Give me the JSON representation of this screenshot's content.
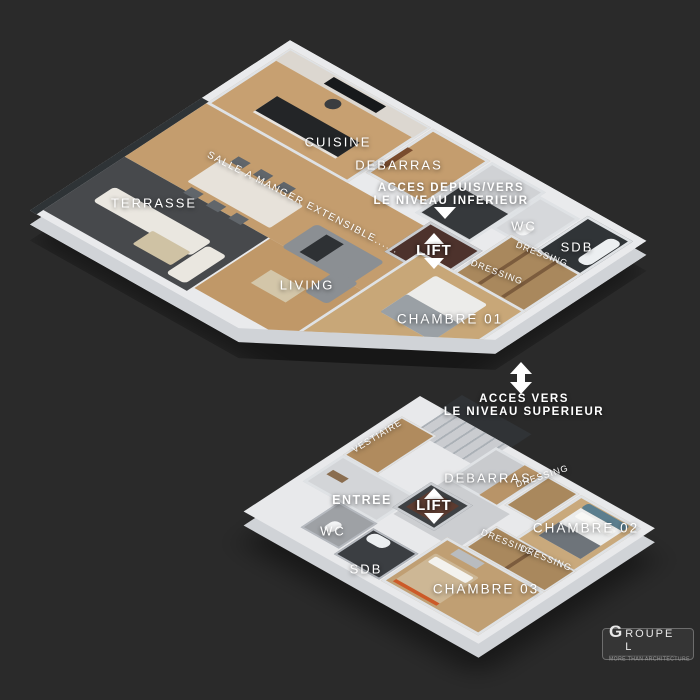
{
  "background": "#2a2a2a",
  "palette": {
    "slab": "#e9eaec",
    "wood_floor": "#c49d6e",
    "terrace_floor": "#47494c",
    "dark_room": "#33363a",
    "dressing_wood": "#a9885d",
    "lift_shaft": "#4d322c",
    "glass": "#8cb1ba",
    "bed_teal": "#5b7e8e",
    "label_text": "#ffffff"
  },
  "upper_floor": {
    "labels": {
      "terrasse": "TERRASSE",
      "cuisine": "CUISINE",
      "debarras": "DEBARRAS",
      "salle_a_manger": "SALLE A MANGER EXTENSIBLE......",
      "living": "LIVING",
      "wc": "WC",
      "sdb": "SDB",
      "dressing_a": "DRESSING",
      "dressing_b": "DRESSING",
      "chambre_01": "CHAMBRE 01",
      "lift": "LIFT"
    },
    "access_note": {
      "line1": "ACCES DEPUIS/VERS",
      "line2": "LE NIVEAU INFERIEUR"
    }
  },
  "stair_note": {
    "line1": "ACCES VERS",
    "line2": "LE NIVEAU SUPERIEUR"
  },
  "lower_floor": {
    "labels": {
      "vestiaire": "VESTIAIRE",
      "entree": "ENTREE",
      "debarras": "DEBARRAS",
      "dressing_hall": "DRESSING",
      "wc": "WC",
      "sdb": "SDB",
      "chambre_02": "CHAMBRE 02",
      "chambre_03": "CHAMBRE 03",
      "dressing_a": "DRESSING",
      "dressing_b": "DRESSING",
      "lift": "LIFT"
    }
  },
  "logo": {
    "initial": "G",
    "rest": "ROUPE L",
    "tagline": "MORE THAN ARCHITECTURE"
  }
}
